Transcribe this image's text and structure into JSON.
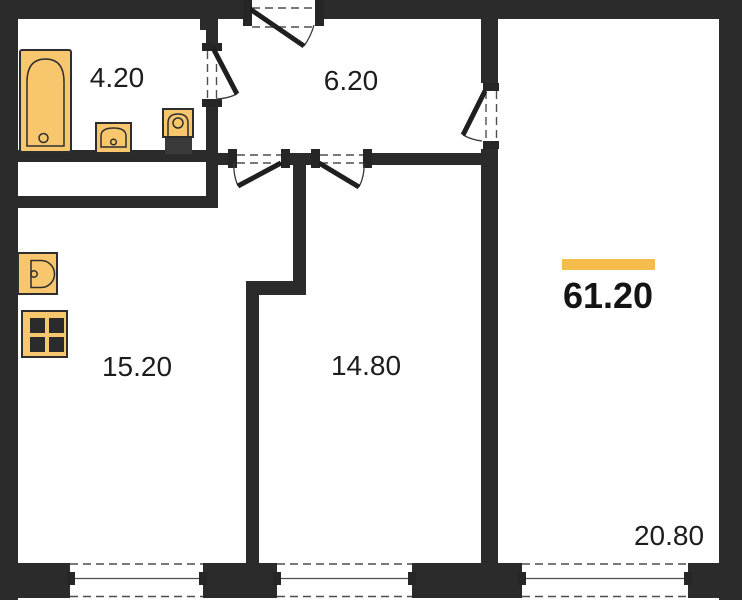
{
  "plan": {
    "total": {
      "area": "61.20"
    },
    "rooms": {
      "bathroom": {
        "area": "4.20"
      },
      "hallway": {
        "area": "6.20"
      },
      "kitchen": {
        "area": "15.20"
      },
      "room_middle": {
        "area": "14.80"
      },
      "room_right": {
        "area": "20.80"
      }
    },
    "icons": {
      "bathtub": "bathtub-icon",
      "bathroom_sink": "sink-icon",
      "toilet": "toilet-icon",
      "kitchen_sink": "kitchen-sink-icon",
      "stove": "stove-icon"
    },
    "colors": {
      "wall": "#2b2b2b",
      "fixture_fill": "#f8c76d",
      "accent": "#f5bb4b",
      "text": "#1d1d1d",
      "background": "#ffffff"
    }
  }
}
